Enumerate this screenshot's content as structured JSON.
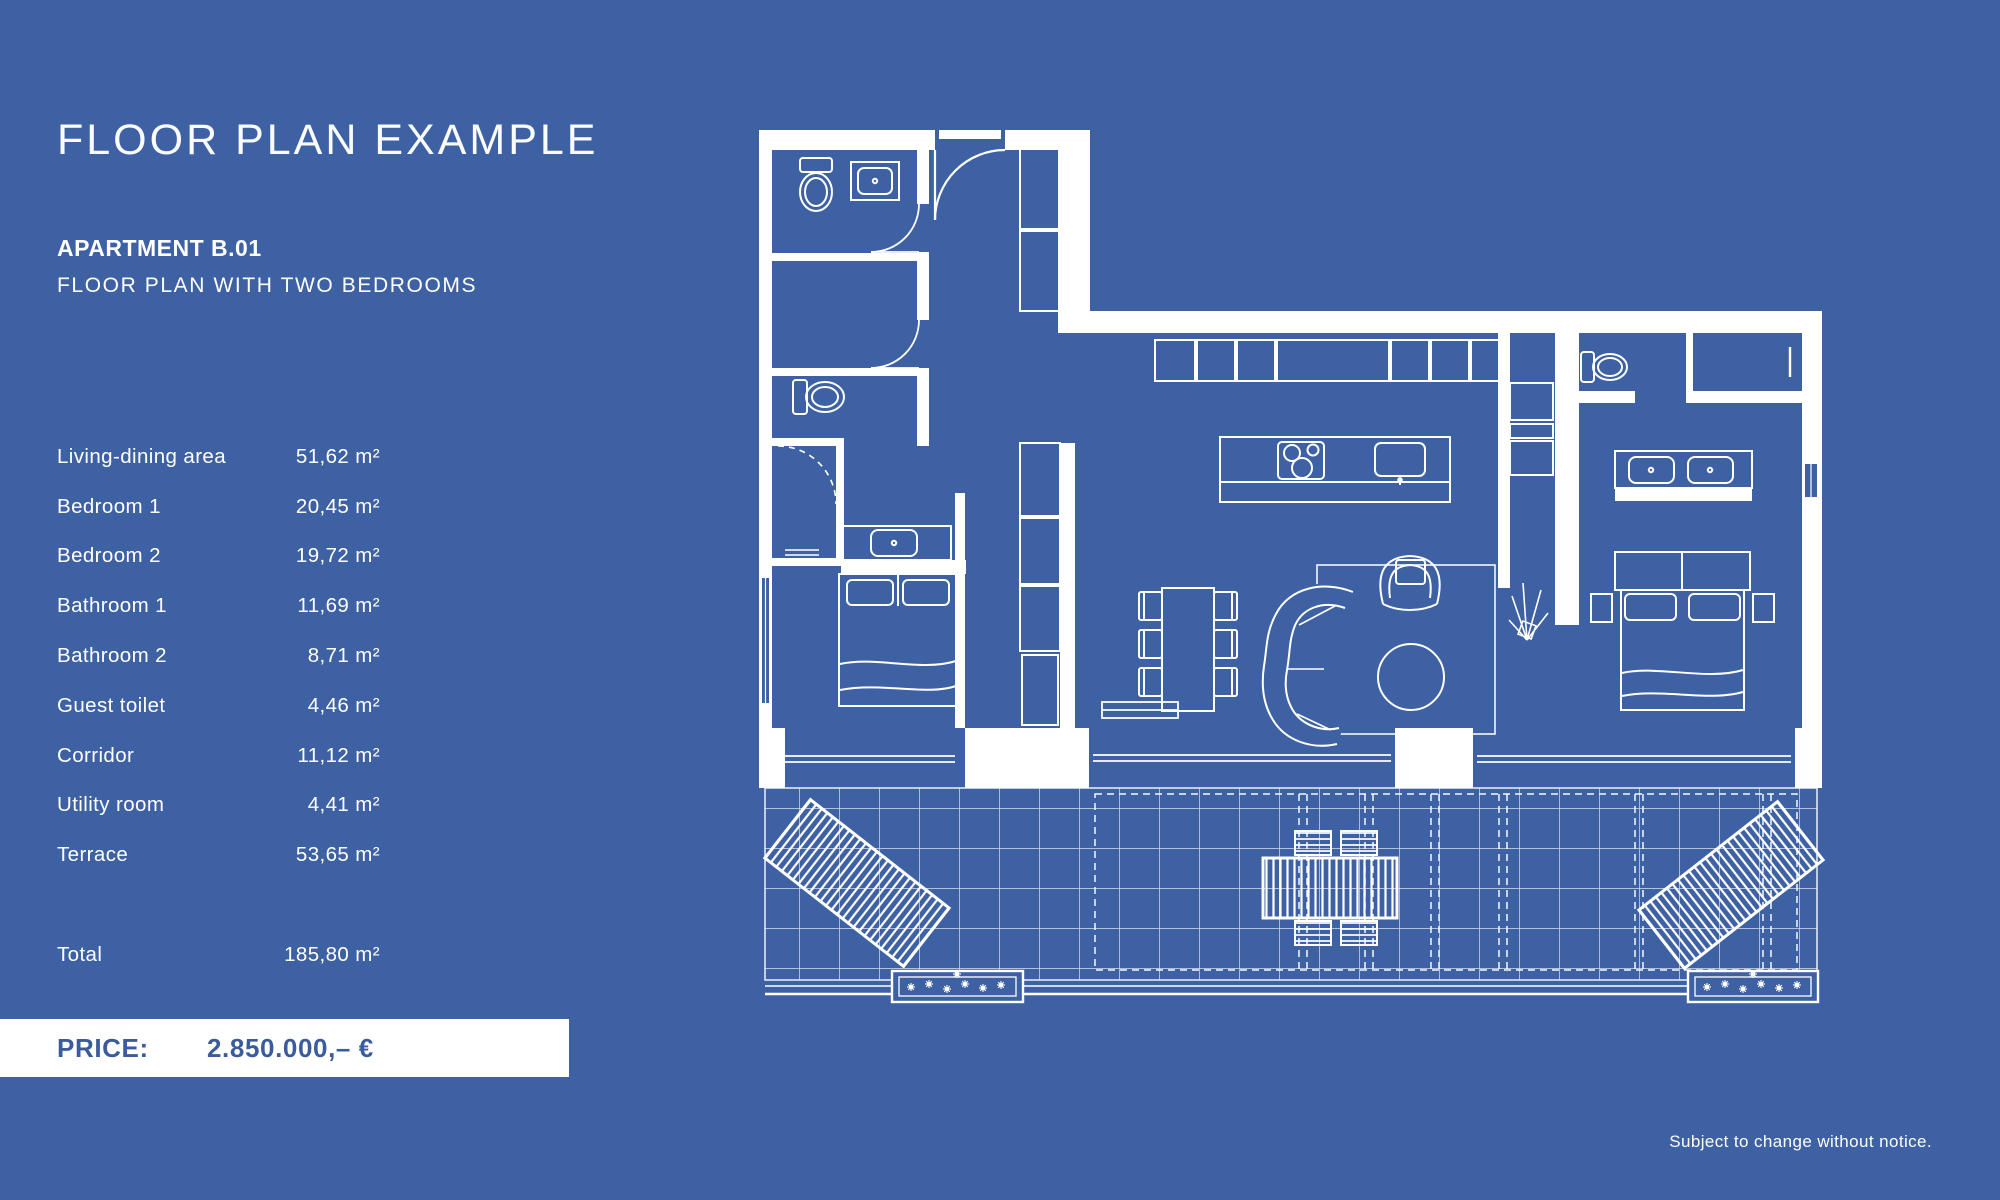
{
  "page": {
    "title": "FLOOR PLAN EXAMPLE",
    "footer_note": "Subject to change without notice."
  },
  "apartment": {
    "name": "APARTMENT B.01",
    "description": "FLOOR PLAN WITH TWO BEDROOMS"
  },
  "area_table": {
    "rows": [
      {
        "label": "Living-dining area",
        "value": "51,62 m²"
      },
      {
        "label": "Bedroom 1",
        "value": "20,45 m²"
      },
      {
        "label": "Bedroom 2",
        "value": "19,72 m²"
      },
      {
        "label": "Bathroom 1",
        "value": "11,69 m²"
      },
      {
        "label": "Bathroom 2",
        "value": "8,71 m²"
      },
      {
        "label": "Guest toilet",
        "value": "4,46 m²"
      },
      {
        "label": "Corridor",
        "value": "11,12 m²"
      },
      {
        "label": "Utility room",
        "value": "4,41 m²"
      },
      {
        "label": "Terrace",
        "value": "53,65 m²"
      }
    ],
    "total": {
      "label": "Total",
      "value": "185,80 m²"
    }
  },
  "price": {
    "label": "PRICE:",
    "value": "2.850.000,– €"
  },
  "colors": {
    "background": "#3e61a4",
    "text": "#ffffff",
    "plan_lines": "#ffffff",
    "price_bar_background": "#ffffff",
    "price_text": "#3a5c9d"
  },
  "floor_plan": {
    "style": "blueprint, white linework on blue",
    "elements": [
      "entrance-door",
      "guest-toilet",
      "utility-room",
      "corridor",
      "bathroom-1",
      "vanity-sink",
      "bed-1",
      "wardrobe",
      "kitchen-cabinets",
      "kitchen-island",
      "cooktop",
      "kitchen-sink",
      "dining-table-six-chairs",
      "curved-sofa",
      "coffee-table",
      "armchair",
      "rug",
      "plant",
      "shelf-niche",
      "bathroom-2",
      "double-vanity",
      "bed-2",
      "closet",
      "sliding-glass-doors",
      "terrace-tiles",
      "sun-lounger-left",
      "sun-lounger-right",
      "outdoor-dining-set",
      "planter-left",
      "planter-right"
    ]
  }
}
